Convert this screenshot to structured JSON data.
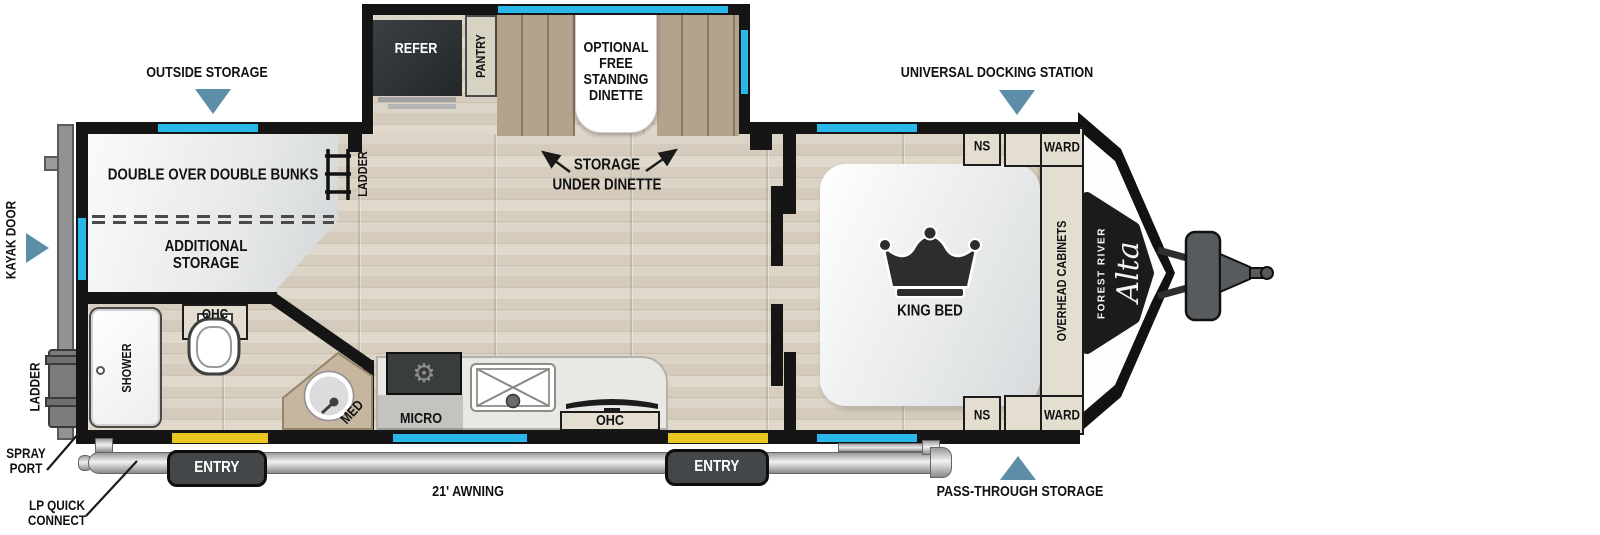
{
  "colors": {
    "wall_black": "#151515",
    "window_blue": "#2ab7ea",
    "marker_blue": "#5d8ea8",
    "entry_yellow": "#eac71e",
    "bench_tan": "#b3a28c",
    "cabinet_beige": "#e3decf"
  },
  "icons": {
    "markers": [
      "triangle-down-icon",
      "triangle-right-icon",
      "triangle-up-icon"
    ],
    "bedroom": "crown-icon",
    "bathroom": [
      "toilet-icon",
      "shower-head-icon",
      "corner-sink-icon"
    ],
    "kitchen": [
      "cooktop-icon",
      "sink-icon",
      "tv-icon"
    ],
    "ladders": [
      "bunk-ladder-icon",
      "rear-ladder-icon"
    ],
    "front": "hitch-icon"
  },
  "callouts": {
    "outside_storage": "OUTSIDE STORAGE",
    "universal_docking_station": "UNIVERSAL DOCKING STATION",
    "pass_through_storage": "PASS-THROUGH STORAGE",
    "kayak_door": "KAYAK DOOR",
    "rear_ladder": "LADDER",
    "spray_port": "SPRAY PORT",
    "lp_quick_connect": "LP QUICK CONNECT",
    "awning": "21' AWNING"
  },
  "doors": {
    "entry": "ENTRY"
  },
  "bunk_room": {
    "bunks": "DOUBLE OVER DOUBLE BUNKS",
    "additional_storage": "ADDITIONAL STORAGE",
    "ladder": "LADDER"
  },
  "bathroom": {
    "shower": "SHOWER",
    "ohc": "OHC",
    "med": "MED"
  },
  "kitchen": {
    "micro": "MICRO",
    "ohc": "OHC"
  },
  "slide_out": {
    "refer": "REFER",
    "pantry": "PANTRY",
    "dinette": "OPTIONAL FREE STANDING DINETTE",
    "storage_under_line1": "STORAGE",
    "storage_under_line2": "UNDER DINETTE"
  },
  "bedroom": {
    "king_bed": "KING BED",
    "overhead_cabinets": "OVERHEAD CABINETS",
    "ns": "NS",
    "ward": "WARD"
  },
  "brand": {
    "maker": "FOREST RIVER",
    "model": "Alta"
  }
}
